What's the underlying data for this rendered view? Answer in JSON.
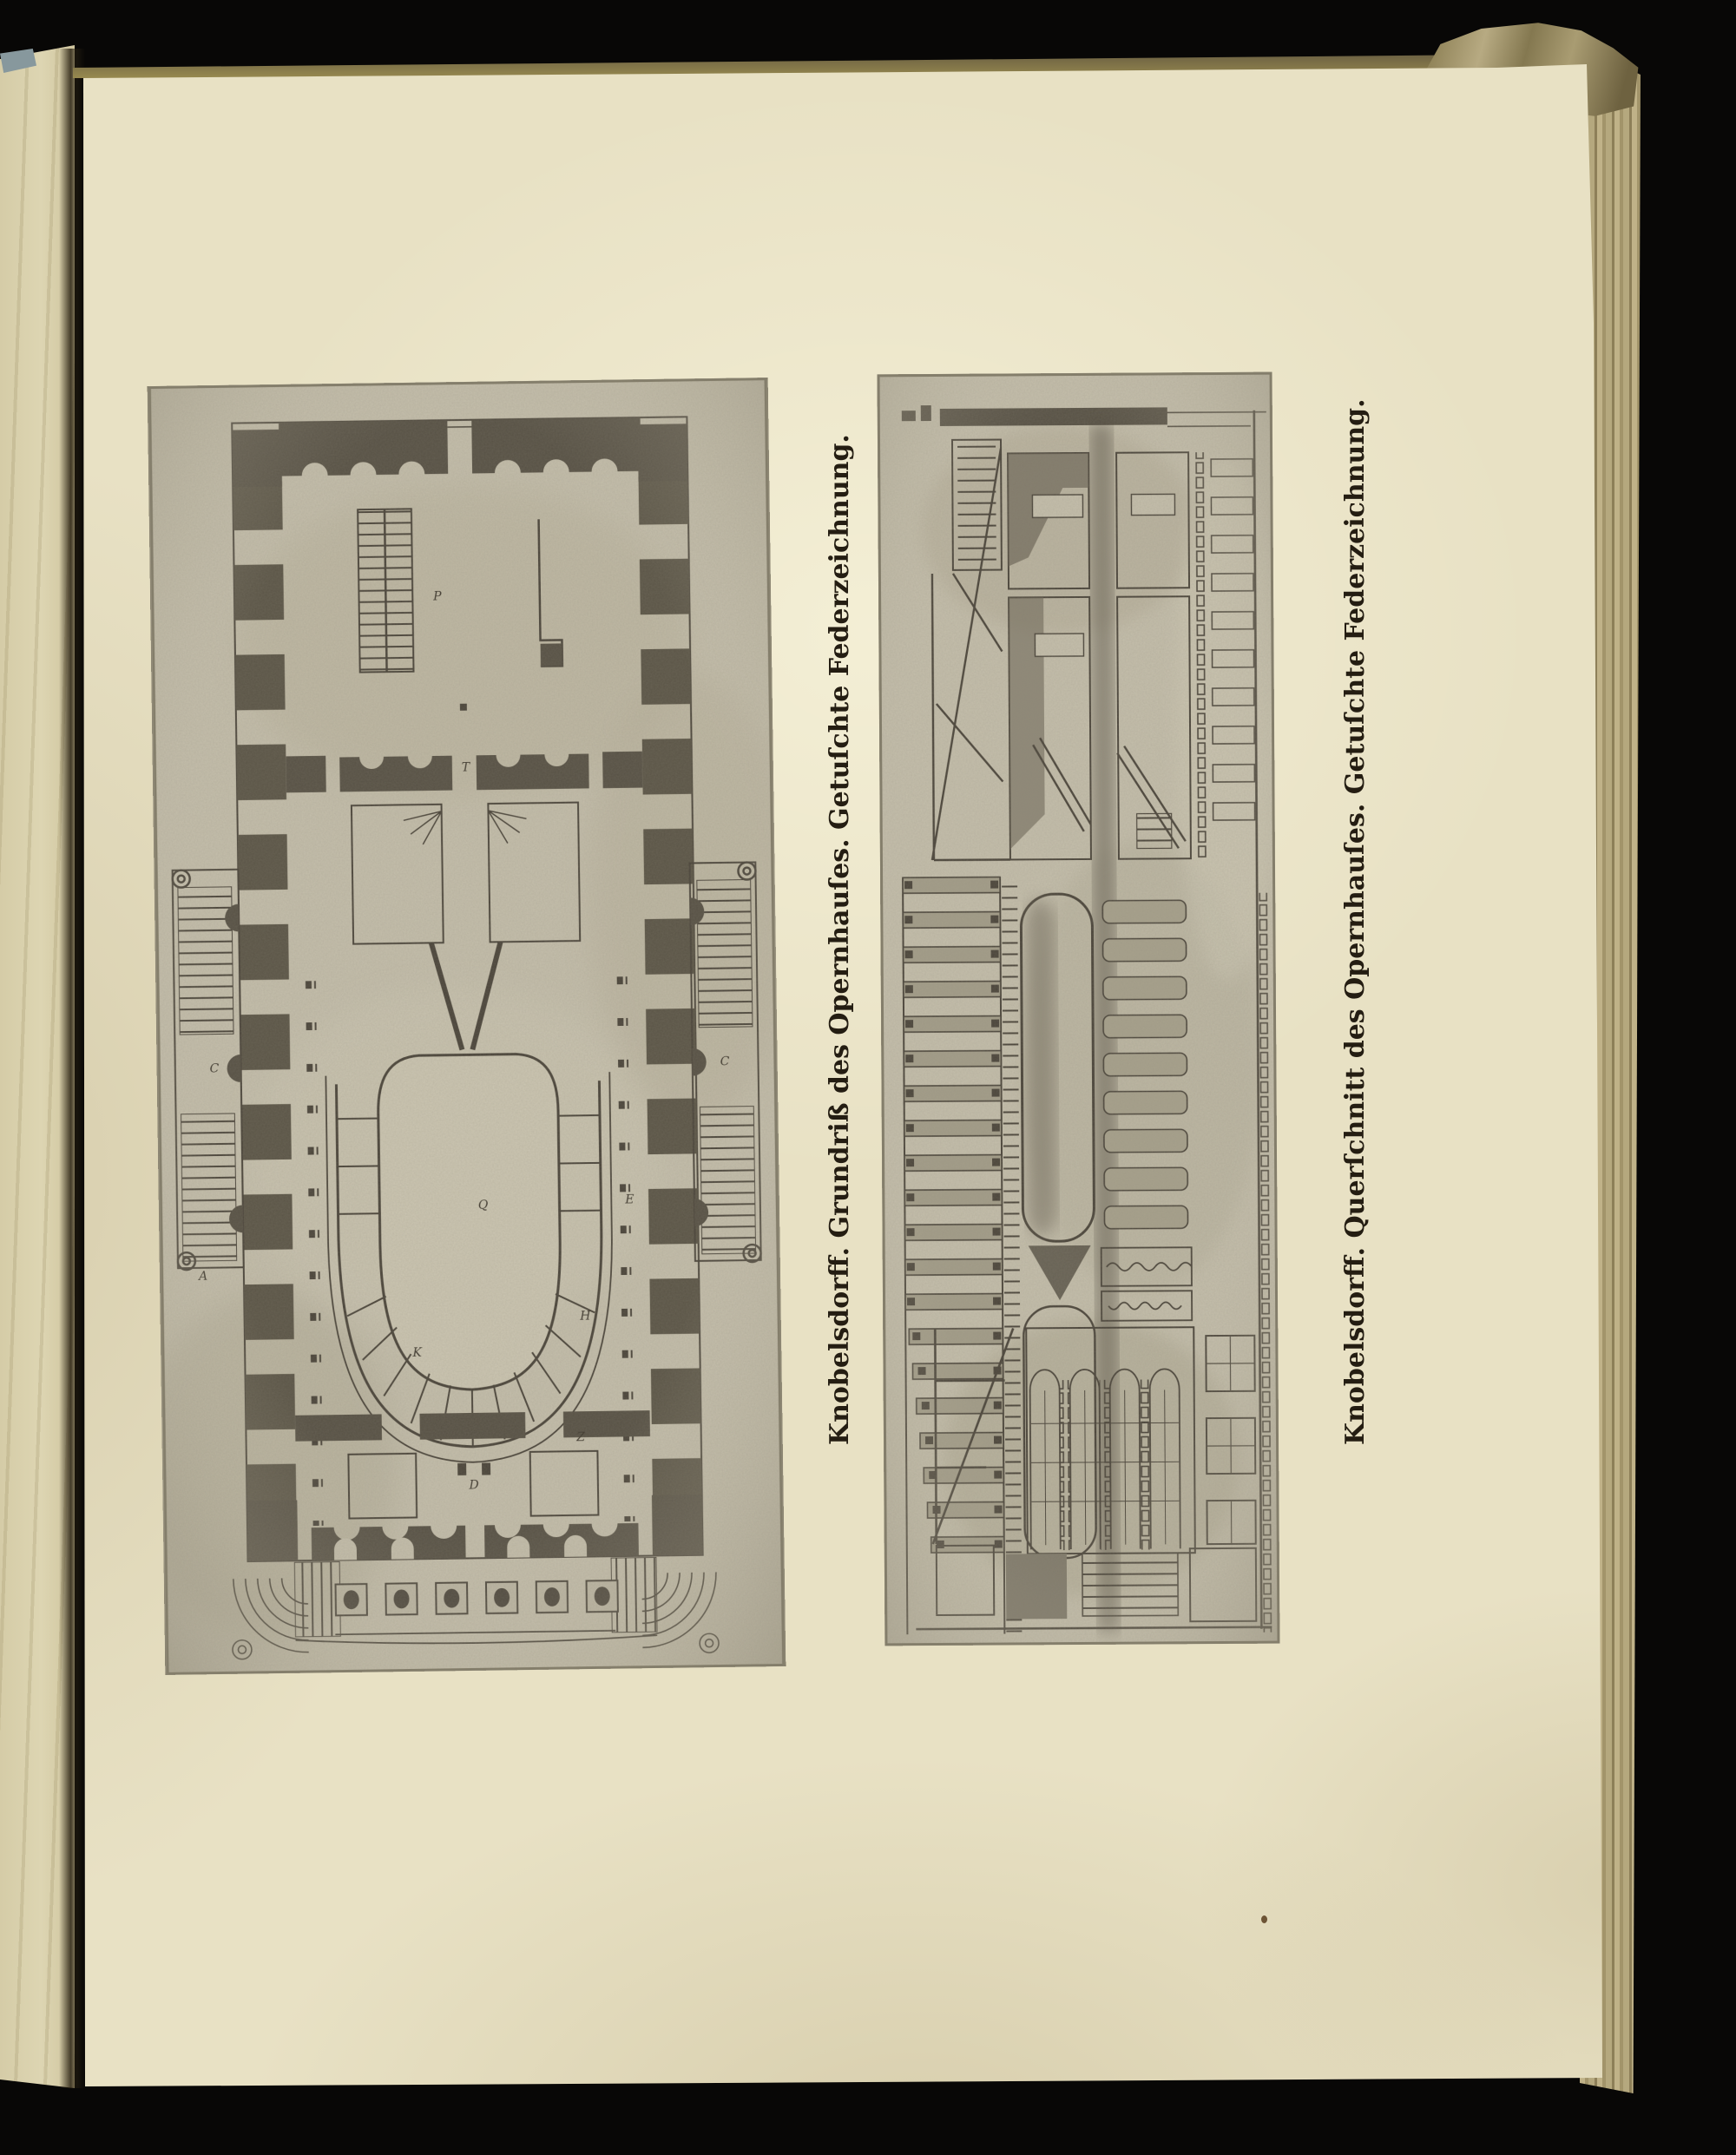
{
  "plates": [
    {
      "id": "grundriss",
      "caption": "Knobelsdorff. Grundriß des Opernhauſes. Getuſchte Federzeichnung.",
      "plan_letters": [
        "A",
        "C",
        "C",
        "D",
        "E",
        "H",
        "K",
        "P",
        "Q",
        "T",
        "Z"
      ]
    },
    {
      "id": "querschnitt",
      "caption": "Knobelsdorff. Querſchnitt des Opernhauſes. Getuſchte Federzeichnung."
    }
  ],
  "colors": {
    "background": "#080706",
    "paper": "#e8e1c4",
    "adjacent_page": "#d9d1ae",
    "plate_halftone": "#c5bfac",
    "drawing_ink": "#4a443a",
    "caption_ink": "#241d12",
    "fore_edge_tan": "#b3a67c",
    "fleck_blue_gray": "#87989d"
  }
}
